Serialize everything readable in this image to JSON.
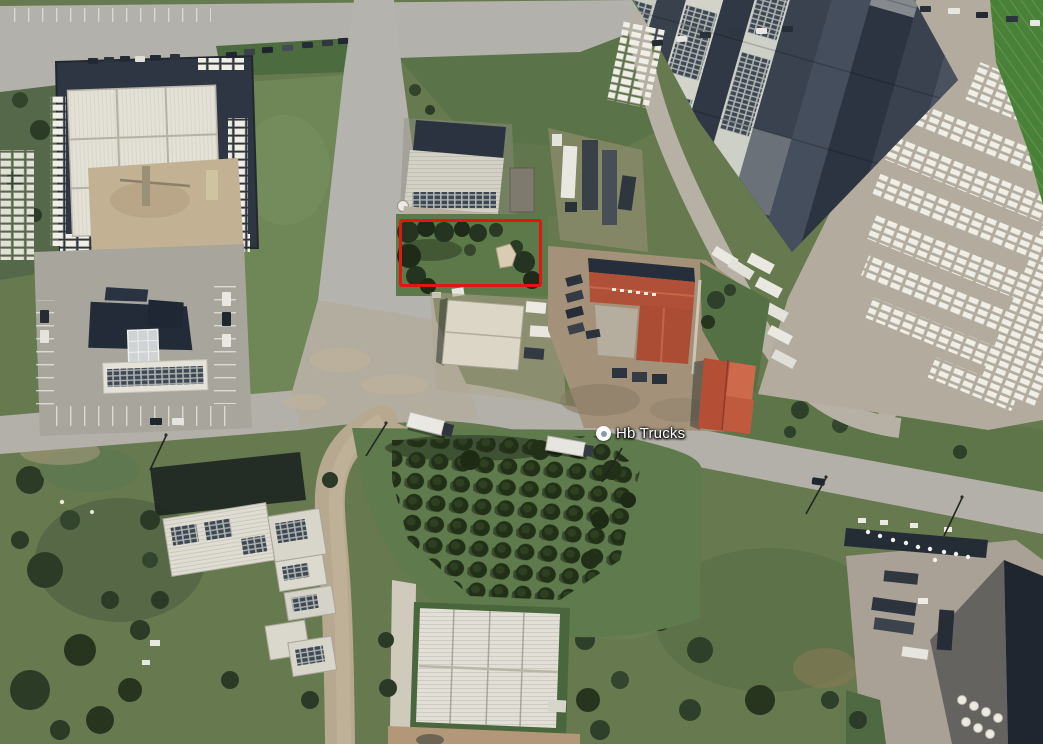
{
  "map": {
    "view": "satellite",
    "poi": {
      "label": "Hb Trucks",
      "marker_icon": "place-dot-marker",
      "marker_color_outer": "#fdfdfd",
      "marker_color_inner": "#8a9aa8",
      "position_px": {
        "x": 604,
        "y": 434
      }
    },
    "annotation": {
      "type": "rectangle-outline",
      "color": "#e41410",
      "bbox_px": {
        "x": 400,
        "y": 219,
        "width": 144,
        "height": 69
      }
    }
  }
}
